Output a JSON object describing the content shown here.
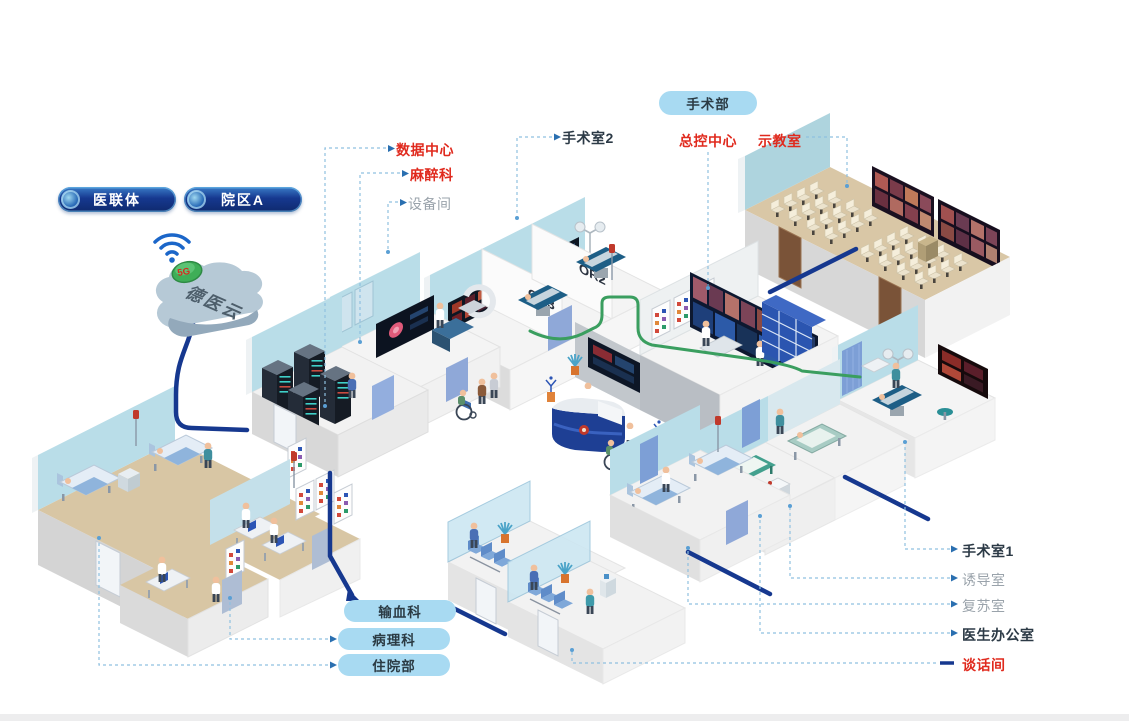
{
  "org_pills": [
    {
      "label": "医联体"
    },
    {
      "label": "院区A"
    }
  ],
  "cloud": {
    "label": "德医云",
    "badge": "5G"
  },
  "dept_pill": {
    "label": "手术部"
  },
  "wall_marks": {
    "or2": "OR2",
    "or3": "OR3"
  },
  "callouts": {
    "top": [
      {
        "id": "operating-room-2",
        "text": "手术室2",
        "style": "dark"
      },
      {
        "id": "master-control-center",
        "text": "总控中心",
        "style": "red"
      },
      {
        "id": "demo-classroom",
        "text": "示教室",
        "style": "red"
      }
    ],
    "left": [
      {
        "id": "data-center",
        "text": "数据中心",
        "style": "red"
      },
      {
        "id": "anesthesiology",
        "text": "麻醉科",
        "style": "red"
      },
      {
        "id": "equipment-room",
        "text": "设备间",
        "style": "gray"
      }
    ],
    "right": [
      {
        "id": "operating-room-1",
        "text": "手术室1",
        "style": "dark"
      },
      {
        "id": "induction-room",
        "text": "诱导室",
        "style": "gray"
      },
      {
        "id": "recovery-room",
        "text": "复苏室",
        "style": "gray"
      },
      {
        "id": "doctors-office",
        "text": "医生办公室",
        "style": "dark"
      },
      {
        "id": "talk-room",
        "text": "谈话间",
        "style": "red"
      }
    ],
    "bottom_pills": [
      {
        "id": "blood-transfusion-dept",
        "text": "输血科"
      },
      {
        "id": "pathology-dept",
        "text": "病理科"
      },
      {
        "id": "inpatient-dept",
        "text": "住院部"
      }
    ]
  },
  "colors": {
    "navy": "#16388f",
    "red": "#e02a1e",
    "gray": "#9aa3ab",
    "dark": "#2c3a46",
    "pill_blue": "#a8daf2",
    "wall_blue": "#b9dde8",
    "floor_tan": "#d8c6a4",
    "green": "#3a9e5f"
  }
}
